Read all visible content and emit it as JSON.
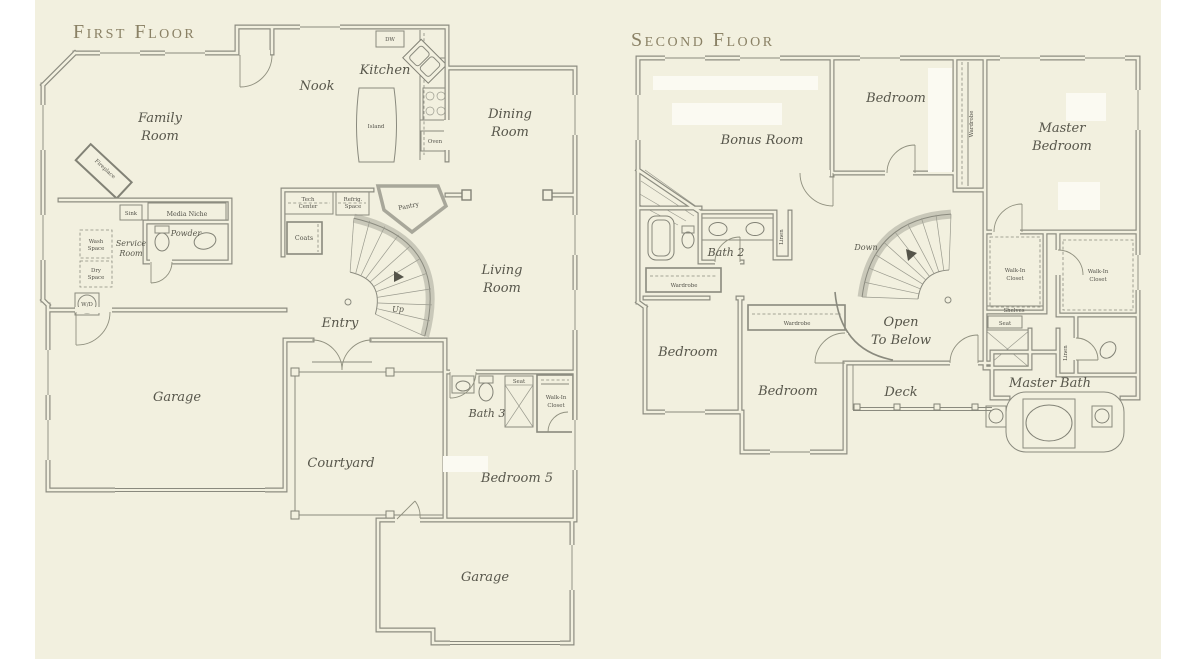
{
  "page": {
    "paper_color": "#f2f0df",
    "ink_color": "#4f4e45",
    "title_color": "#8a8165"
  },
  "first_floor": {
    "title": "First Floor",
    "labels": {
      "family_room_1": "Family",
      "family_room_2": "Room",
      "nook": "Nook",
      "kitchen": "Kitchen",
      "island": "Island",
      "dw": "DW",
      "oven": "Oven",
      "dining_1": "Dining",
      "dining_2": "Room",
      "living_1": "Living",
      "living_2": "Room",
      "fireplace": "Fireplace",
      "sink": "Sink",
      "media_niche": "Media Niche",
      "powder": "Powder",
      "service_1": "Service",
      "service_2": "Room",
      "wash_1": "Wash",
      "wash_2": "Space",
      "dry_1": "Dry",
      "dry_2": "Space",
      "wd": "W/D",
      "tech_1": "Tech",
      "tech_2": "Center",
      "refrig_1": "Refrig.",
      "refrig_2": "Space",
      "pantry": "Pantry",
      "coats": "Coats",
      "up": "Up",
      "entry": "Entry",
      "garage": "Garage",
      "courtyard": "Courtyard",
      "bath3": "Bath 3",
      "seat": "Seat",
      "wic_1": "Walk-In",
      "wic_2": "Closet",
      "bedroom5": "Bedroom 5",
      "rear_garage": "Garage"
    }
  },
  "second_floor": {
    "title": "Second Floor",
    "labels": {
      "bonus_room": "Bonus Room",
      "bedroom_top": "Bedroom",
      "master_1": "Master",
      "master_2": "Bedroom",
      "wardrobe_top": "Wardrobe",
      "bath2": "Bath 2",
      "linen_left": "Linen",
      "wardrobe_left": "Wardrobe",
      "bedroom_left": "Bedroom",
      "wardrobe_mid": "Wardrobe",
      "bedroom_mid": "Bedroom",
      "down": "Down",
      "open_1": "Open",
      "open_2": "To Below",
      "wic1_1": "Walk-In",
      "wic1_2": "Closet",
      "shelves": "Shelves",
      "seat": "Seat",
      "wic2_1": "Walk-In",
      "wic2_2": "Closet",
      "linen_right": "Linen",
      "deck": "Deck",
      "master_bath": "Master Bath"
    }
  }
}
